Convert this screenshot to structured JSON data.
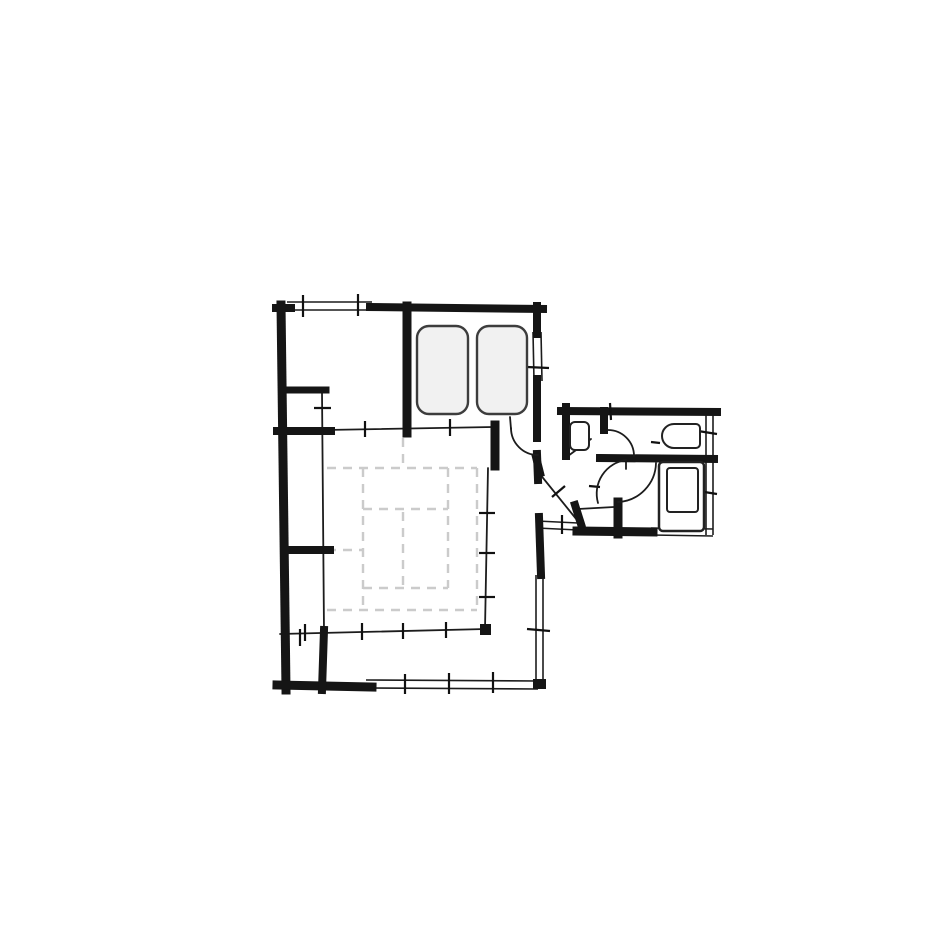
{
  "page": {
    "width": 940,
    "height": 940,
    "background": "#ffffff"
  },
  "floorplan": {
    "layers": [
      {
        "name": "tatami-grid",
        "kind": "lines",
        "color": "#cbcbcb",
        "width": 2.4,
        "dash": "9 7",
        "linecap": "butt",
        "segments": [
          [
            327,
            468,
            477,
            468
          ],
          [
            363,
            509,
            448,
            509
          ],
          [
            327,
            550,
            363,
            550
          ],
          [
            363,
            588,
            448,
            588
          ],
          [
            327,
            610,
            477,
            610
          ],
          [
            363,
            468,
            363,
            610
          ],
          [
            448,
            468,
            448,
            588
          ],
          [
            403,
            438,
            403,
            468
          ],
          [
            403,
            512,
            403,
            588
          ],
          [
            477,
            468,
            477,
            610
          ]
        ]
      },
      {
        "name": "window-lines",
        "kind": "lines",
        "color": "#1c1c1c",
        "width": 1.6,
        "linecap": "butt",
        "segments": [
          [
            287,
            302,
            372,
            302
          ],
          [
            287,
            310,
            372,
            310
          ],
          [
            533,
            332,
            534,
            381
          ],
          [
            541,
            332,
            542,
            381
          ],
          [
            366,
            680,
            538,
            681
          ],
          [
            366,
            688,
            538,
            689
          ],
          [
            536,
            575,
            536,
            681
          ],
          [
            543,
            575,
            543,
            681
          ],
          [
            706,
            414,
            706,
            535
          ],
          [
            713,
            414,
            713,
            535
          ],
          [
            651,
            528,
            713,
            529
          ],
          [
            651,
            535,
            713,
            536
          ],
          [
            537,
            521,
            578,
            523
          ],
          [
            537,
            528,
            578,
            530
          ]
        ]
      },
      {
        "name": "thin-walls",
        "kind": "lines",
        "color": "#1c1c1c",
        "width": 1.8,
        "linecap": "round",
        "segments": [
          [
            325,
            430,
            493,
            427
          ],
          [
            322,
            392,
            324,
            631
          ],
          [
            488,
            468,
            485,
            629
          ],
          [
            280,
            634,
            486,
            629
          ],
          [
            539,
            473,
            577,
            520
          ],
          [
            578,
            509,
            614,
            507
          ],
          [
            568,
            456,
            591,
            439
          ],
          [
            510,
            417,
            511,
            429
          ],
          [
            626,
            459,
            626,
            469
          ]
        ]
      },
      {
        "name": "thick-walls",
        "kind": "lines",
        "color": "#151515",
        "width": 8,
        "linecap": "square",
        "segments": [
          [
            276,
            308,
            291,
            308
          ],
          [
            370,
            307,
            543,
            309
          ],
          [
            281,
            305,
            286,
            690,
            9
          ],
          [
            277,
            685,
            372,
            687,
            9
          ],
          [
            537,
            306,
            537,
            334
          ],
          [
            537,
            379,
            537,
            438
          ],
          [
            537,
            454,
            538,
            480
          ],
          [
            539,
            517,
            541,
            575
          ],
          [
            407,
            306,
            407,
            433,
            9
          ],
          [
            286,
            390,
            326,
            390,
            7
          ],
          [
            277,
            431,
            331,
            431
          ],
          [
            286,
            550,
            330,
            550
          ],
          [
            324,
            630,
            322,
            690
          ],
          [
            495,
            425,
            495,
            466,
            9
          ],
          [
            561,
            411,
            717,
            412
          ],
          [
            566,
            407,
            566,
            456
          ],
          [
            600,
            458,
            714,
            459
          ],
          [
            577,
            531,
            653,
            532,
            9
          ],
          [
            618,
            502,
            618,
            534,
            9
          ],
          [
            604,
            411,
            604,
            430
          ],
          [
            575,
            505,
            581,
            524
          ],
          [
            536,
            457,
            540,
            473
          ]
        ]
      },
      {
        "name": "tick-marks",
        "kind": "lines",
        "color": "#111111",
        "width": 2.2,
        "linecap": "butt",
        "segments": [
          [
            303,
            295,
            303,
            317
          ],
          [
            358,
            294,
            358,
            316
          ],
          [
            527,
            367,
            549,
            368
          ],
          [
            365,
            421,
            365,
            437
          ],
          [
            450,
            419,
            450,
            436
          ],
          [
            314,
            408,
            331,
            408
          ],
          [
            479,
            513,
            495,
            513
          ],
          [
            479,
            553,
            495,
            553
          ],
          [
            479,
            597,
            495,
            597
          ],
          [
            305,
            624,
            305,
            641
          ],
          [
            362,
            623,
            362,
            640
          ],
          [
            403,
            623,
            403,
            639
          ],
          [
            446,
            622,
            446,
            638
          ],
          [
            405,
            674,
            405,
            694
          ],
          [
            449,
            673,
            449,
            694
          ],
          [
            493,
            672,
            493,
            693
          ],
          [
            527,
            629,
            550,
            631
          ],
          [
            300,
            629,
            300,
            646
          ],
          [
            610,
            403,
            611,
            420
          ],
          [
            698,
            431,
            717,
            434
          ],
          [
            698,
            491,
            717,
            494
          ],
          [
            552,
            497,
            565,
            486
          ],
          [
            562,
            515,
            562,
            534
          ],
          [
            589,
            486,
            600,
            487
          ],
          [
            651,
            442,
            660,
            443
          ]
        ]
      },
      {
        "name": "door-arcs",
        "kind": "paths",
        "color": "#1c1c1c",
        "width": 1.8,
        "items": [
          {
            "name": "entry-door-arc",
            "d": "M 511 428 A 27 27 0 0 0 538 455"
          },
          {
            "name": "toilet-door-arc",
            "d": "M 608 430 A 26 26 0 0 1 634 456"
          },
          {
            "name": "bath-door-arc-1",
            "d": "M 626 460 A 34 34 0 0 0 598 503"
          },
          {
            "name": "bath-door-arc-2",
            "d": "M 618 502 A 40 40 0 0 0 656 463"
          }
        ]
      },
      {
        "name": "wall-nodes",
        "kind": "rects",
        "color": "#151515",
        "items": [
          {
            "name": "wall-node",
            "x": 480,
            "y": 624,
            "w": 11,
            "h": 11
          },
          {
            "name": "wall-node",
            "x": 533,
            "y": 679,
            "w": 13,
            "h": 10
          }
        ]
      },
      {
        "name": "furniture",
        "kind": "shapes",
        "items": [
          {
            "name": "bed-left",
            "type": "rrect",
            "x": 417,
            "y": 326,
            "w": 51,
            "h": 88,
            "rx": 12,
            "stroke": "#3d3d3d",
            "width": 2.4,
            "fill": "#f1f1f1"
          },
          {
            "name": "bed-right",
            "type": "rrect",
            "x": 477,
            "y": 326,
            "w": 50,
            "h": 88,
            "rx": 12,
            "stroke": "#3d3d3d",
            "width": 2.4,
            "fill": "#f1f1f1"
          },
          {
            "name": "washbasin",
            "type": "rrect",
            "x": 570,
            "y": 422,
            "w": 19,
            "h": 28,
            "rx": 5,
            "stroke": "#222222",
            "width": 2,
            "fill": "#ffffff"
          },
          {
            "name": "bathtub-outer",
            "type": "rrect",
            "x": 659,
            "y": 462,
            "w": 45,
            "h": 69,
            "rx": 4,
            "stroke": "#222222",
            "width": 2.5,
            "fill": "#ffffff"
          },
          {
            "name": "bathtub-inner",
            "type": "rrect",
            "x": 667,
            "y": 468,
            "w": 31,
            "h": 44,
            "rx": 3,
            "stroke": "#222222",
            "width": 2,
            "fill": "none"
          },
          {
            "name": "toilet",
            "type": "path",
            "d": "M 696 424 L 674 424 A 12 12 0 0 0 674 448 L 696 448 A 4 4 0 0 0 700 444 L 700 428 A 4 4 0 0 0 696 424 Z",
            "stroke": "#222222",
            "width": 2,
            "fill": "#ffffff"
          }
        ]
      }
    ]
  }
}
